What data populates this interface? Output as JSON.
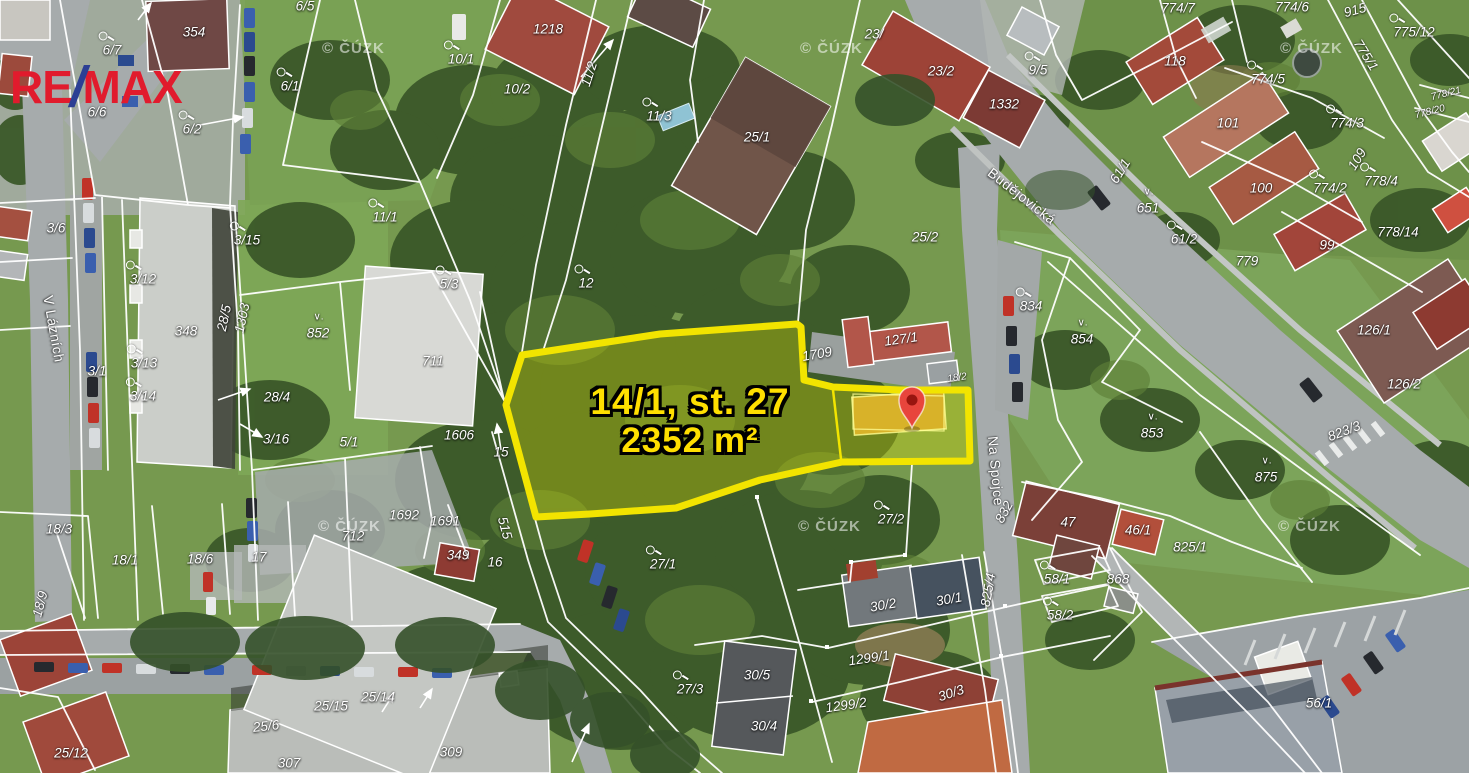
{
  "branding": {
    "logo": {
      "part1": "RE",
      "slash": "/",
      "part2": "MAX"
    }
  },
  "colors": {
    "highlight_outline": "#f2e400",
    "highlight_text": "#ffdf00",
    "pin": "#e8453c",
    "pin_core": "#99150f",
    "logo_red": "#e11b2d",
    "logo_blue": "#2c3f94",
    "boundary": "#ffffff"
  },
  "highlight": {
    "line1": "14/1, st. 27",
    "line2": "2352 m²"
  },
  "map": {
    "attribution": {
      "text": "© ČÚZK",
      "positions": [
        {
          "x": 322,
          "y": 40
        },
        {
          "x": 800,
          "y": 40
        },
        {
          "x": 1280,
          "y": 40
        },
        {
          "x": 318,
          "y": 518
        },
        {
          "x": 798,
          "y": 518
        },
        {
          "x": 1278,
          "y": 518
        }
      ]
    },
    "labels": [
      {
        "t": "Budějovická",
        "x": 1022,
        "y": 196,
        "r": 38,
        "st": 1
      },
      {
        "t": "Na Spojce",
        "x": 996,
        "y": 471,
        "r": 85,
        "st": 1
      },
      {
        "t": "V Lázních",
        "x": 54,
        "y": 329,
        "r": 80,
        "st": 1
      },
      {
        "t": "6/7",
        "x": 112,
        "y": 50,
        "i": 1
      },
      {
        "t": "354",
        "x": 194,
        "y": 32
      },
      {
        "t": "6/5",
        "x": 305,
        "y": 6
      },
      {
        "t": "6/1",
        "x": 290,
        "y": 86,
        "i": 1
      },
      {
        "t": "6/6",
        "x": 97,
        "y": 112
      },
      {
        "t": "6/2",
        "x": 192,
        "y": 129,
        "i": 1
      },
      {
        "t": "3/6",
        "x": 56,
        "y": 228
      },
      {
        "t": "10/1",
        "x": 461,
        "y": 59,
        "i": 1
      },
      {
        "t": "10/2",
        "x": 517,
        "y": 89
      },
      {
        "t": "1218",
        "x": 548,
        "y": 29
      },
      {
        "t": "11/2",
        "x": 589,
        "y": 74,
        "r": -72
      },
      {
        "t": "11/1",
        "x": 385,
        "y": 217,
        "i": 1
      },
      {
        "t": "3/15",
        "x": 247,
        "y": 240,
        "i": 1
      },
      {
        "t": "12",
        "x": 586,
        "y": 283,
        "i": 1
      },
      {
        "t": "11/3",
        "x": 659,
        "y": 116,
        "i": 1
      },
      {
        "t": "25/1",
        "x": 757,
        "y": 137
      },
      {
        "t": "23/",
        "x": 874,
        "y": 34
      },
      {
        "t": "23/2",
        "x": 941,
        "y": 71
      },
      {
        "t": "9/5",
        "x": 1038,
        "y": 70,
        "i": 1
      },
      {
        "t": "1332",
        "x": 1004,
        "y": 104
      },
      {
        "t": "25/2",
        "x": 925,
        "y": 237
      },
      {
        "t": "774/7",
        "x": 1178,
        "y": 8
      },
      {
        "t": "774/6",
        "x": 1292,
        "y": 7
      },
      {
        "t": "915",
        "x": 1355,
        "y": 10,
        "r": -15
      },
      {
        "t": "775/12",
        "x": 1414,
        "y": 32,
        "i": 1
      },
      {
        "t": "775/1",
        "x": 1366,
        "y": 55,
        "r": 58
      },
      {
        "t": "118",
        "x": 1175,
        "y": 61
      },
      {
        "t": "774/5",
        "x": 1268,
        "y": 79,
        "i": 1
      },
      {
        "t": "101",
        "x": 1228,
        "y": 123
      },
      {
        "t": "774/3",
        "x": 1347,
        "y": 123,
        "i": 1
      },
      {
        "t": "109",
        "x": 1357,
        "y": 159,
        "r": -58
      },
      {
        "t": "774/2",
        "x": 1330,
        "y": 188,
        "i": 1
      },
      {
        "t": "778/4",
        "x": 1381,
        "y": 181,
        "i": 1
      },
      {
        "t": "778/21",
        "x": 1446,
        "y": 94,
        "r": -14,
        "s": 10
      },
      {
        "t": "778/20",
        "x": 1430,
        "y": 112,
        "r": -14,
        "s": 10
      },
      {
        "t": "100",
        "x": 1261,
        "y": 188
      },
      {
        "t": "99",
        "x": 1327,
        "y": 245
      },
      {
        "t": "778/14",
        "x": 1398,
        "y": 232
      },
      {
        "t": "779",
        "x": 1247,
        "y": 261
      },
      {
        "t": "61/1",
        "x": 1120,
        "y": 171,
        "r": -58
      },
      {
        "t": "651",
        "x": 1148,
        "y": 208,
        "v": 1
      },
      {
        "t": "61/2",
        "x": 1184,
        "y": 239,
        "i": 1
      },
      {
        "t": "3/12",
        "x": 143,
        "y": 279,
        "i": 1
      },
      {
        "t": "348",
        "x": 186,
        "y": 331
      },
      {
        "t": "28/5",
        "x": 224,
        "y": 318,
        "r": -78
      },
      {
        "t": "1303",
        "x": 242,
        "y": 318,
        "r": -78
      },
      {
        "t": "852",
        "x": 318,
        "y": 333,
        "v": 1
      },
      {
        "t": "3/13",
        "x": 144,
        "y": 363,
        "i": 1
      },
      {
        "t": "3/1",
        "x": 97,
        "y": 371
      },
      {
        "t": "3/14",
        "x": 143,
        "y": 396,
        "i": 1
      },
      {
        "t": "28/4",
        "x": 277,
        "y": 397
      },
      {
        "t": "3/16",
        "x": 276,
        "y": 439
      },
      {
        "t": "5/3",
        "x": 449,
        "y": 284,
        "i": 1
      },
      {
        "t": "711",
        "x": 433,
        "y": 361
      },
      {
        "t": "5/1",
        "x": 349,
        "y": 442
      },
      {
        "t": "1606",
        "x": 459,
        "y": 435
      },
      {
        "t": "15",
        "x": 501,
        "y": 452
      },
      {
        "t": "1692",
        "x": 404,
        "y": 515
      },
      {
        "t": "1691",
        "x": 445,
        "y": 521
      },
      {
        "t": "712",
        "x": 353,
        "y": 536
      },
      {
        "t": "349",
        "x": 458,
        "y": 555
      },
      {
        "t": "515",
        "x": 505,
        "y": 528,
        "r": 75
      },
      {
        "t": "16",
        "x": 495,
        "y": 562
      },
      {
        "t": "17",
        "x": 259,
        "y": 557
      },
      {
        "t": "18/3",
        "x": 59,
        "y": 529
      },
      {
        "t": "18/1",
        "x": 125,
        "y": 560
      },
      {
        "t": "18/6",
        "x": 200,
        "y": 559
      },
      {
        "t": "18/9",
        "x": 40,
        "y": 604,
        "r": -75
      },
      {
        "t": "25/12",
        "x": 71,
        "y": 753
      },
      {
        "t": "25/6",
        "x": 266,
        "y": 726,
        "r": -6
      },
      {
        "t": "25/15",
        "x": 331,
        "y": 706
      },
      {
        "t": "25/14",
        "x": 378,
        "y": 697
      },
      {
        "t": "307",
        "x": 289,
        "y": 763
      },
      {
        "t": "309",
        "x": 451,
        "y": 752
      },
      {
        "t": "27/1",
        "x": 663,
        "y": 564,
        "i": 1
      },
      {
        "t": "27/3",
        "x": 690,
        "y": 689,
        "i": 1
      },
      {
        "t": "27/2",
        "x": 891,
        "y": 519,
        "i": 1
      },
      {
        "t": "1709",
        "x": 817,
        "y": 354,
        "r": -10
      },
      {
        "t": "127/1",
        "x": 901,
        "y": 339,
        "r": -8
      },
      {
        "t": "18/2",
        "x": 957,
        "y": 378,
        "r": -8,
        "s": 10
      },
      {
        "t": "832",
        "x": 1004,
        "y": 512,
        "r": -62
      },
      {
        "t": "834",
        "x": 1031,
        "y": 306,
        "i": 1
      },
      {
        "t": "854",
        "x": 1082,
        "y": 339,
        "v": 1
      },
      {
        "t": "853",
        "x": 1152,
        "y": 433,
        "v": 1
      },
      {
        "t": "875",
        "x": 1266,
        "y": 477,
        "v": 1
      },
      {
        "t": "823/3",
        "x": 1344,
        "y": 431,
        "r": -21
      },
      {
        "t": "126/1",
        "x": 1374,
        "y": 330
      },
      {
        "t": "126/2",
        "x": 1404,
        "y": 384
      },
      {
        "t": "47",
        "x": 1068,
        "y": 522
      },
      {
        "t": "46/1",
        "x": 1138,
        "y": 530
      },
      {
        "t": "825/1",
        "x": 1190,
        "y": 547
      },
      {
        "t": "868",
        "x": 1118,
        "y": 579
      },
      {
        "t": "58/1",
        "x": 1057,
        "y": 579,
        "i": 1
      },
      {
        "t": "58/2",
        "x": 1060,
        "y": 615,
        "i": 1
      },
      {
        "t": "825/4",
        "x": 988,
        "y": 590,
        "r": -80
      },
      {
        "t": "30/2",
        "x": 883,
        "y": 605,
        "r": -10
      },
      {
        "t": "30/1",
        "x": 949,
        "y": 599,
        "r": -10
      },
      {
        "t": "1299/1",
        "x": 869,
        "y": 658,
        "r": -8
      },
      {
        "t": "1299/2",
        "x": 846,
        "y": 705,
        "r": -8
      },
      {
        "t": "30/5",
        "x": 757,
        "y": 675
      },
      {
        "t": "30/4",
        "x": 764,
        "y": 726
      },
      {
        "t": "30/3",
        "x": 951,
        "y": 693,
        "r": -18
      },
      {
        "t": "56/1",
        "x": 1319,
        "y": 703
      }
    ]
  }
}
